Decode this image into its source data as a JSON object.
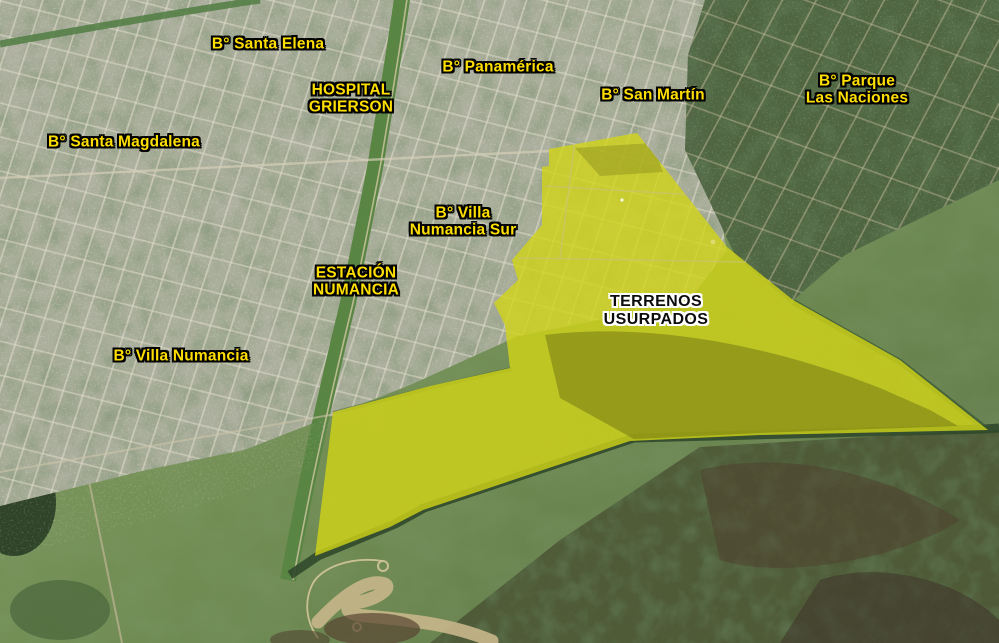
{
  "map": {
    "description": "Aerial satellite view with neighborhood annotations",
    "labels": {
      "santa_elena": {
        "text": "B° Santa Elena"
      },
      "hospital_grierson": {
        "text": "HOSPITAL\nGRIERSON"
      },
      "panamerica": {
        "text": "B° Panamérica"
      },
      "san_martin": {
        "text": "B° San Martín"
      },
      "parque_las_naciones": {
        "text": "B° Parque\nLas Naciones"
      },
      "santa_magdalena": {
        "text": "B° Santa Magdalena"
      },
      "villa_numancia_sur": {
        "text": "B° Villa\nNumancia Sur"
      },
      "estacion_numancia": {
        "text": "ESTACIÓN\nNUMANCIA"
      },
      "villa_numancia": {
        "text": "B° Villa Numancia"
      },
      "terrenos_usurpados": {
        "text": "TERRENOS\nUSURPADOS"
      }
    },
    "overlay": {
      "name": "terrenos-usurpados-area",
      "polygon_points": "549,149 637,133 727,247 793,300 900,360 988,430 760,435 630,441 423,510 390,527 315,556 333,412 430,386 510,368 505,325 494,303 518,280 512,260 542,225 542,167 549,166",
      "fill": "#d2d611",
      "opacity": 0.8
    },
    "colors": {
      "label_text": "#ffdf00",
      "label_outline": "#000000",
      "area_label_text": "#0c0c0c",
      "area_label_outline": "#ffffff",
      "overlay_yellow": "#c1c52c",
      "field_green": "#6f8c50",
      "city_gray": "#aeb0a0"
    }
  }
}
